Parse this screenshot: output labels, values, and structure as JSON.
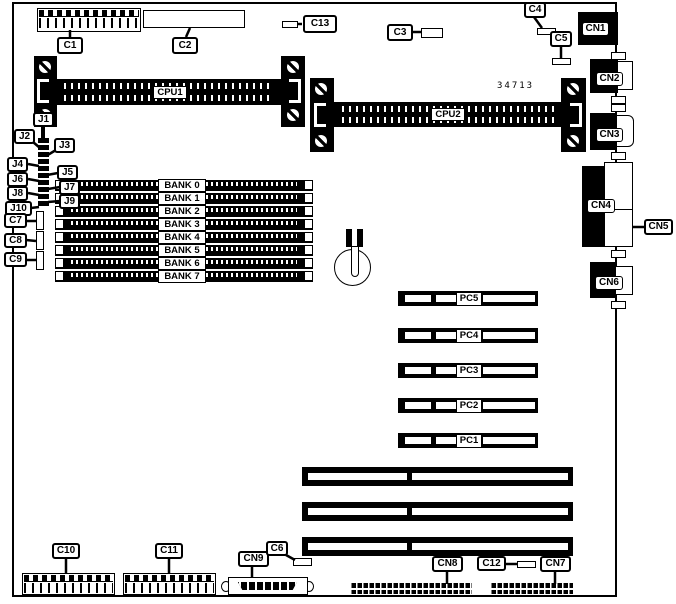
{
  "board": {
    "part_number": "34713",
    "cpu_slots": [
      {
        "label": "CPU1"
      },
      {
        "label": "CPU2"
      }
    ],
    "memory_banks": [
      {
        "label": "BANK 0"
      },
      {
        "label": "BANK 1"
      },
      {
        "label": "BANK 2"
      },
      {
        "label": "BANK 3"
      },
      {
        "label": "BANK 4"
      },
      {
        "label": "BANK 5"
      },
      {
        "label": "BANK 6"
      },
      {
        "label": "BANK 7"
      }
    ],
    "expansion_slots": [
      {
        "label": "PC5"
      },
      {
        "label": "PC4"
      },
      {
        "label": "PC3"
      },
      {
        "label": "PC2"
      },
      {
        "label": "PC1"
      }
    ],
    "jumpers": [
      {
        "label": "J1"
      },
      {
        "label": "J2"
      },
      {
        "label": "J3"
      },
      {
        "label": "J4"
      },
      {
        "label": "J5"
      },
      {
        "label": "J6"
      },
      {
        "label": "J7"
      },
      {
        "label": "J8"
      },
      {
        "label": "J9"
      },
      {
        "label": "J10"
      }
    ],
    "components": {
      "c1": "C1",
      "c2": "C2",
      "c3": "C3",
      "c4": "C4",
      "c5": "C5",
      "c6": "C6",
      "c7": "C7",
      "c8": "C8",
      "c9": "C9",
      "c10": "C10",
      "c11": "C11",
      "c12": "C12",
      "c13": "C13"
    },
    "connectors": {
      "cn1": "CN1",
      "cn2": "CN2",
      "cn3": "CN3",
      "cn4": "CN4",
      "cn5": "CN5",
      "cn6": "CN6",
      "cn7": "CN7",
      "cn8": "CN8",
      "cn9": "CN9"
    },
    "colors": {
      "ink": "#000000",
      "background": "#ffffff"
    }
  }
}
